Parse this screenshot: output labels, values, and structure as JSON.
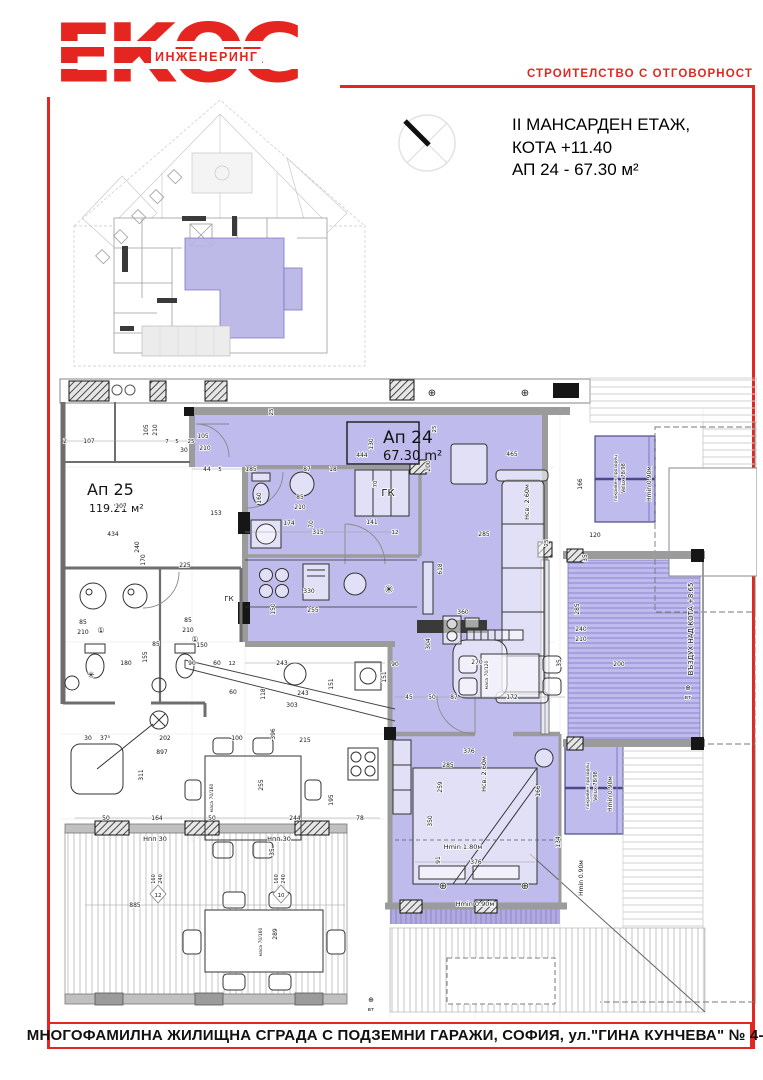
{
  "brand": {
    "logo_main": "ЕКОС",
    "logo_sub": "ИНЖЕНЕРИНГ",
    "tagline": "СТРОИТЕЛСТВО С ОТГОВОРНОСТ"
  },
  "title_block": {
    "line1": "II МАНСАРДЕН ЕТАЖ,",
    "line2": "КОТА +11.40",
    "line3": "АП 24 - 67.30 м²"
  },
  "footer": {
    "address": "МНОГОФАМИЛНА ЖИЛИЩНА СГРАДА С ПОДЗЕМНИ ГАРАЖИ, СОФИЯ, ул.\"ГИНА КУНЧЕВА\"  № 4-6"
  },
  "colors": {
    "brand_red": "#e52620",
    "apartment_highlight": "#bfbbec",
    "deck_line": "#8d87cf",
    "wall_gray": "#b9b9b9"
  },
  "plan": {
    "apt24_label": "Ап 24",
    "apt24_area": "67.30 m²",
    "apt25_label": "Ап 25",
    "apt25_area": "119.21 м²",
    "labels": [
      {
        "t": "Ап 24",
        "x": 328,
        "y": 71,
        "s": 17,
        "big": 1
      },
      {
        "t": "67.30 m²",
        "x": 328,
        "y": 88,
        "s": 13,
        "big": 1
      },
      {
        "t": "Ап 25",
        "x": 32,
        "y": 123,
        "s": 16,
        "big": 1
      },
      {
        "t": "119.21 м²",
        "x": 34,
        "y": 140,
        "s": 11,
        "big": 1
      },
      {
        "t": "ГК",
        "x": 333,
        "y": 124,
        "s": 10
      },
      {
        "t": "ГК",
        "x": 174,
        "y": 229,
        "s": 7
      },
      {
        "t": "Нсв. 2.60м",
        "x": 474,
        "y": 130,
        "s": 6.5,
        "r": -90
      },
      {
        "t": "Нсв. 2.60м",
        "x": 431,
        "y": 402,
        "s": 6.5,
        "r": -90
      },
      {
        "t": "Hmin 1.80м",
        "x": 408,
        "y": 477,
        "s": 6.5
      },
      {
        "t": "Hmin 0.90м",
        "x": 596,
        "y": 112,
        "s": 6,
        "r": -90
      },
      {
        "t": "Hmin 0.90м",
        "x": 557,
        "y": 422,
        "s": 6,
        "r": -90
      },
      {
        "t": "Hmin 0.90м",
        "x": 420,
        "y": 534,
        "s": 6.5
      },
      {
        "t": "Hmin 0.90м",
        "x": 528,
        "y": 506,
        "s": 6,
        "r": -90
      },
      {
        "t": "ВЪЗДУХ НАД КОТА +8.65",
        "x": 638,
        "y": 257,
        "s": 7,
        "r": -90
      },
      {
        "t": "Velux 78/98",
        "x": 570,
        "y": 106,
        "s": 5,
        "r": -90
      },
      {
        "t": "покривен прозорец",
        "x": 562,
        "y": 106,
        "s": 4.5,
        "r": -90
      },
      {
        "t": "Velux 78/98",
        "x": 542,
        "y": 414,
        "s": 5,
        "r": -90
      },
      {
        "t": "покривен прозорец",
        "x": 534,
        "y": 414,
        "s": 4.5,
        "r": -90
      },
      {
        "t": "маса 70/120",
        "x": 433,
        "y": 303,
        "s": 4.5,
        "r": -90
      },
      {
        "t": "маса 70/160",
        "x": 158,
        "y": 426,
        "s": 4.5,
        "r": -90
      },
      {
        "t": "маса 70/160",
        "x": 207,
        "y": 570,
        "s": 4.5,
        "r": -90
      },
      {
        "t": "Hпп 30",
        "x": 100,
        "y": 469,
        "s": 6.5
      },
      {
        "t": "Hпп 30",
        "x": 224,
        "y": 469,
        "s": 6.5
      },
      {
        "t": "⊕",
        "x": 633,
        "y": 318,
        "s": 7
      },
      {
        "t": "вт",
        "x": 633,
        "y": 327,
        "s": 5.5
      },
      {
        "t": "⊕",
        "x": 316,
        "y": 630,
        "s": 7
      },
      {
        "t": "вт",
        "x": 316,
        "y": 639,
        "s": 5.5
      },
      {
        "t": "✳",
        "x": 334,
        "y": 221,
        "s": 11
      },
      {
        "t": "✳",
        "x": 36,
        "y": 306,
        "s": 9
      },
      {
        "t": "105",
        "x": 93,
        "y": 58,
        "s": 6,
        "r": -90
      },
      {
        "t": "210",
        "x": 102,
        "y": 58,
        "s": 6,
        "r": -90
      },
      {
        "t": "107",
        "x": 34,
        "y": 71,
        "s": 6
      },
      {
        "t": "2",
        "x": 10,
        "y": 71,
        "s": 6
      },
      {
        "t": "107",
        "x": 66,
        "y": 136,
        "s": 6
      },
      {
        "t": "105",
        "x": 148,
        "y": 66,
        "s": 6
      },
      {
        "t": "210",
        "x": 150,
        "y": 78,
        "s": 6
      },
      {
        "t": "30",
        "x": 129,
        "y": 80,
        "s": 6
      },
      {
        "t": "7",
        "x": 112,
        "y": 71,
        "s": 5.5
      },
      {
        "t": "5",
        "x": 122,
        "y": 71,
        "s": 5.5
      },
      {
        "t": "25",
        "x": 136,
        "y": 71,
        "s": 5.5
      },
      {
        "t": "44",
        "x": 152,
        "y": 99,
        "s": 6
      },
      {
        "t": "5",
        "x": 165,
        "y": 99,
        "s": 5.5
      },
      {
        "t": "444",
        "x": 307,
        "y": 85,
        "s": 6
      },
      {
        "t": "185",
        "x": 196,
        "y": 99,
        "s": 6
      },
      {
        "t": "87",
        "x": 252,
        "y": 99,
        "s": 6
      },
      {
        "t": "18",
        "x": 278,
        "y": 99,
        "s": 6
      },
      {
        "t": "130",
        "x": 318,
        "y": 72,
        "s": 6,
        "r": -90
      },
      {
        "t": "153",
        "x": 161,
        "y": 143,
        "s": 6
      },
      {
        "t": "434",
        "x": 58,
        "y": 164,
        "s": 6
      },
      {
        "t": "240",
        "x": 84,
        "y": 175,
        "s": 6,
        "r": -90
      },
      {
        "t": "170",
        "x": 90,
        "y": 188,
        "s": 6,
        "r": -90
      },
      {
        "t": "225",
        "x": 130,
        "y": 195,
        "s": 6
      },
      {
        "t": "315",
        "x": 263,
        "y": 162,
        "s": 6
      },
      {
        "t": "174",
        "x": 234,
        "y": 153,
        "s": 6
      },
      {
        "t": "141",
        "x": 317,
        "y": 152,
        "s": 6
      },
      {
        "t": "12",
        "x": 340,
        "y": 162,
        "s": 5.5
      },
      {
        "t": "160",
        "x": 206,
        "y": 126,
        "s": 6,
        "r": -90
      },
      {
        "t": "85",
        "x": 245,
        "y": 127,
        "s": 6
      },
      {
        "t": "210",
        "x": 245,
        "y": 137,
        "s": 6
      },
      {
        "t": "70",
        "x": 258,
        "y": 152,
        "s": 6,
        "r": -90
      },
      {
        "t": "70",
        "x": 322,
        "y": 112,
        "s": 5.5,
        "r": -90
      },
      {
        "t": "330",
        "x": 254,
        "y": 221,
        "s": 6
      },
      {
        "t": "255",
        "x": 258,
        "y": 240,
        "s": 6
      },
      {
        "t": "150",
        "x": 220,
        "y": 237,
        "s": 6,
        "r": -90
      },
      {
        "t": "360",
        "x": 408,
        "y": 242,
        "s": 6
      },
      {
        "t": "618",
        "x": 387,
        "y": 197,
        "s": 6,
        "r": -90
      },
      {
        "t": "285",
        "x": 429,
        "y": 164,
        "s": 6
      },
      {
        "t": "465",
        "x": 457,
        "y": 84,
        "s": 6
      },
      {
        "t": "200",
        "x": 375,
        "y": 94,
        "s": 6,
        "r": -90
      },
      {
        "t": "166",
        "x": 527,
        "y": 112,
        "s": 6,
        "r": -90
      },
      {
        "t": "120",
        "x": 540,
        "y": 165,
        "s": 6
      },
      {
        "t": "35",
        "x": 532,
        "y": 186,
        "s": 6,
        "r": -90
      },
      {
        "t": "285",
        "x": 524,
        "y": 237,
        "s": 6,
        "r": -90
      },
      {
        "t": "240",
        "x": 526,
        "y": 259,
        "s": 6
      },
      {
        "t": "210",
        "x": 526,
        "y": 269,
        "s": 6
      },
      {
        "t": "200",
        "x": 564,
        "y": 294,
        "s": 6
      },
      {
        "t": "35",
        "x": 506,
        "y": 291,
        "s": 6,
        "r": -90
      },
      {
        "t": "270",
        "x": 422,
        "y": 292,
        "s": 6
      },
      {
        "t": "172",
        "x": 457,
        "y": 327,
        "s": 6
      },
      {
        "t": "87",
        "x": 399,
        "y": 327,
        "s": 6
      },
      {
        "t": "50",
        "x": 377,
        "y": 327,
        "s": 6
      },
      {
        "t": "45",
        "x": 354,
        "y": 327,
        "s": 6
      },
      {
        "t": "90",
        "x": 340,
        "y": 294,
        "s": 6
      },
      {
        "t": "151",
        "x": 331,
        "y": 305,
        "s": 6,
        "r": -90
      },
      {
        "t": "304",
        "x": 375,
        "y": 272,
        "s": 6,
        "r": -90
      },
      {
        "t": "376",
        "x": 414,
        "y": 381,
        "s": 6
      },
      {
        "t": "285",
        "x": 393,
        "y": 395,
        "s": 6
      },
      {
        "t": "259",
        "x": 387,
        "y": 415,
        "s": 6,
        "r": -90
      },
      {
        "t": "350",
        "x": 377,
        "y": 449,
        "s": 6,
        "r": -90
      },
      {
        "t": "166",
        "x": 485,
        "y": 419,
        "s": 6,
        "r": -90
      },
      {
        "t": "134",
        "x": 505,
        "y": 470,
        "s": 6,
        "r": -90
      },
      {
        "t": "91",
        "x": 385,
        "y": 488,
        "s": 6,
        "r": -90
      },
      {
        "t": "376",
        "x": 421,
        "y": 492,
        "s": 6
      },
      {
        "t": "243",
        "x": 227,
        "y": 293,
        "s": 6
      },
      {
        "t": "243",
        "x": 248,
        "y": 323,
        "s": 6
      },
      {
        "t": "151",
        "x": 278,
        "y": 312,
        "s": 6,
        "r": -90
      },
      {
        "t": "303",
        "x": 237,
        "y": 335,
        "s": 6
      },
      {
        "t": "118",
        "x": 210,
        "y": 322,
        "s": 6,
        "r": -90
      },
      {
        "t": "60",
        "x": 178,
        "y": 322,
        "s": 6
      },
      {
        "t": "396",
        "x": 220,
        "y": 362,
        "s": 6,
        "r": -90
      },
      {
        "t": "215",
        "x": 250,
        "y": 370,
        "s": 6
      },
      {
        "t": "100",
        "x": 182,
        "y": 368,
        "s": 6
      },
      {
        "t": "202",
        "x": 110,
        "y": 368,
        "s": 6
      },
      {
        "t": "897",
        "x": 107,
        "y": 382,
        "s": 6
      },
      {
        "t": "311",
        "x": 88,
        "y": 403,
        "s": 6,
        "r": -90
      },
      {
        "t": "30",
        "x": 33,
        "y": 368,
        "s": 6
      },
      {
        "t": "37⁵",
        "x": 50,
        "y": 368,
        "s": 6
      },
      {
        "t": "164",
        "x": 102,
        "y": 448,
        "s": 6
      },
      {
        "t": "50",
        "x": 51,
        "y": 448,
        "s": 6
      },
      {
        "t": "50",
        "x": 157,
        "y": 448,
        "s": 6
      },
      {
        "t": "244",
        "x": 240,
        "y": 448,
        "s": 6
      },
      {
        "t": "78",
        "x": 305,
        "y": 448,
        "s": 6
      },
      {
        "t": "195",
        "x": 278,
        "y": 428,
        "s": 6,
        "r": -90
      },
      {
        "t": "255",
        "x": 208,
        "y": 413,
        "s": 6,
        "r": -90
      },
      {
        "t": "85",
        "x": 28,
        "y": 252,
        "s": 6
      },
      {
        "t": "210",
        "x": 28,
        "y": 262,
        "s": 6
      },
      {
        "t": "①",
        "x": 46,
        "y": 261,
        "s": 8
      },
      {
        "t": "85",
        "x": 133,
        "y": 250,
        "s": 6
      },
      {
        "t": "210",
        "x": 133,
        "y": 260,
        "s": 6
      },
      {
        "t": "①",
        "x": 140,
        "y": 270,
        "s": 8
      },
      {
        "t": "180",
        "x": 71,
        "y": 293,
        "s": 6
      },
      {
        "t": "90",
        "x": 137,
        "y": 293,
        "s": 6
      },
      {
        "t": "150",
        "x": 147,
        "y": 275,
        "s": 6
      },
      {
        "t": "85",
        "x": 101,
        "y": 274,
        "s": 6
      },
      {
        "t": "155",
        "x": 92,
        "y": 285,
        "s": 6,
        "r": -90
      },
      {
        "t": "60",
        "x": 162,
        "y": 293,
        "s": 6
      },
      {
        "t": "12",
        "x": 177,
        "y": 293,
        "s": 5.5
      },
      {
        "t": "885",
        "x": 80,
        "y": 535,
        "s": 6
      },
      {
        "t": "289",
        "x": 222,
        "y": 562,
        "s": 6,
        "r": -90
      },
      {
        "t": "160",
        "x": 100,
        "y": 507,
        "s": 5,
        "r": -90
      },
      {
        "t": "240",
        "x": 107,
        "y": 507,
        "s": 5,
        "r": -90
      },
      {
        "t": "12",
        "x": 103,
        "y": 525,
        "s": 5.5
      },
      {
        "t": "160",
        "x": 223,
        "y": 507,
        "s": 5,
        "r": -90
      },
      {
        "t": "240",
        "x": 230,
        "y": 507,
        "s": 5,
        "r": -90
      },
      {
        "t": "10",
        "x": 226,
        "y": 525,
        "s": 5.5
      },
      {
        "t": "35",
        "x": 219,
        "y": 480,
        "s": 6,
        "r": -90
      },
      {
        "t": "25",
        "x": 381,
        "y": 57,
        "s": 5.5,
        "r": -90
      },
      {
        "t": "25",
        "x": 218,
        "y": 40,
        "s": 5.5,
        "r": -90
      },
      {
        "t": "25",
        "x": 493,
        "y": 171,
        "s": 5.5,
        "r": -90
      },
      {
        "t": "⊕",
        "x": 377,
        "y": 24,
        "s": 10
      },
      {
        "t": "⊕",
        "x": 470,
        "y": 24,
        "s": 10
      },
      {
        "t": "⊕",
        "x": 388,
        "y": 517,
        "s": 10
      },
      {
        "t": "⊕",
        "x": 470,
        "y": 517,
        "s": 10
      }
    ]
  }
}
